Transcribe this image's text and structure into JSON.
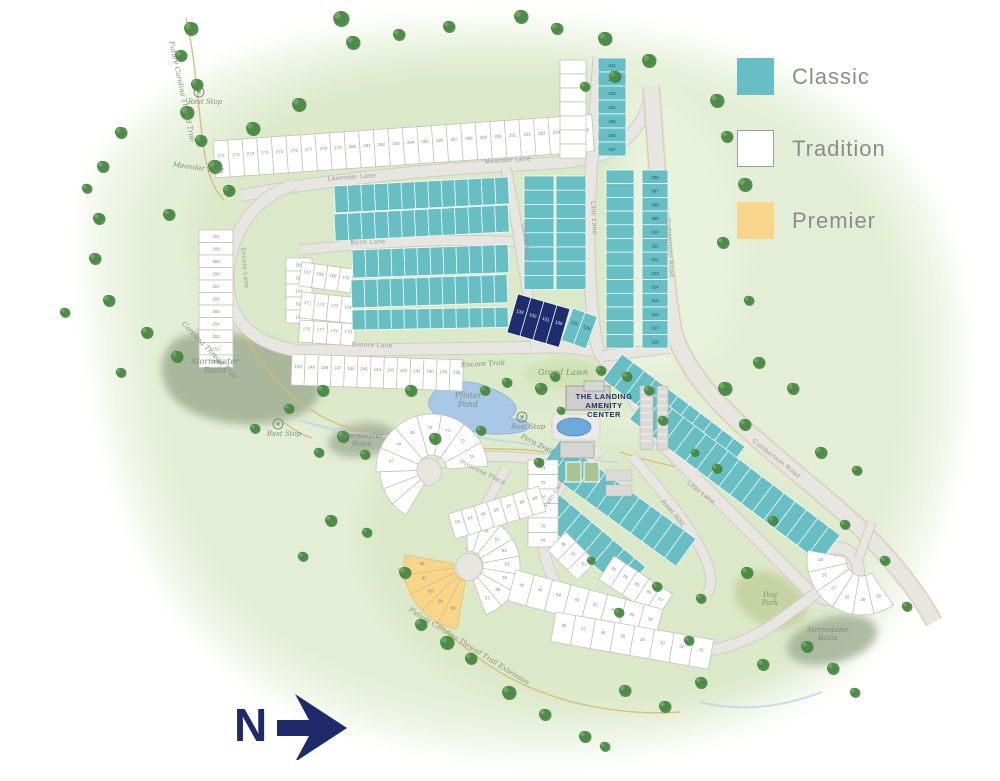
{
  "legend": {
    "items": [
      {
        "name": "classic",
        "label": "Classic",
        "fill": "#67bfc4",
        "border": "#67bfc4"
      },
      {
        "name": "tradition",
        "label": "Tradition",
        "fill": "#ffffff",
        "border": "#9aa09a"
      },
      {
        "name": "premier",
        "label": "Premier",
        "fill": "#f7d68c",
        "border": "#f7d68c"
      }
    ]
  },
  "north": {
    "label": "N",
    "color": "#1f2a6b"
  },
  "amenity": {
    "lines": [
      "THE LANDING",
      "AMENITY",
      "CENTER"
    ],
    "x": 604,
    "y": 399,
    "color": "#1c3461"
  },
  "road_labels": [
    {
      "text": "Lavender Lane",
      "x": 352,
      "y": 179,
      "rot": -4
    },
    {
      "text": "Meander Lane",
      "x": 508,
      "y": 162,
      "rot": -4
    },
    {
      "text": "Encore Lane",
      "x": 372,
      "y": 347,
      "rot": 2
    },
    {
      "text": "Encore Lane",
      "x": 243,
      "y": 268,
      "rot": 85
    },
    {
      "text": "Birch Lane",
      "x": 368,
      "y": 244,
      "rot": -2
    },
    {
      "text": "Clover Way",
      "x": 524,
      "y": 242,
      "rot": 84
    },
    {
      "text": "Lilac Lane",
      "x": 592,
      "y": 218,
      "rot": 87
    },
    {
      "text": "Lilac Lane",
      "x": 700,
      "y": 494,
      "rot": 38
    },
    {
      "text": "Cuthbertson Road",
      "x": 668,
      "y": 248,
      "rot": 86
    },
    {
      "text": "Cuthbertson Road",
      "x": 775,
      "y": 460,
      "rot": 38
    },
    {
      "text": "Fern Lane",
      "x": 556,
      "y": 494,
      "rot": -58
    },
    {
      "text": "Aster Way",
      "x": 672,
      "y": 514,
      "rot": 48
    },
    {
      "text": "Primrose Place",
      "x": 482,
      "y": 474,
      "rot": 26
    }
  ],
  "trail_labels": [
    {
      "text": "Meander Trail",
      "x": 198,
      "y": 170,
      "rot": 8
    },
    {
      "text": "Carolina Thread Trail",
      "x": 208,
      "y": 352,
      "rot": 46
    },
    {
      "text": "Future Carolina Thread Trail Extension",
      "x": 468,
      "y": 648,
      "rot": 32
    },
    {
      "text": "Future Carolina Thread Trail",
      "x": 180,
      "y": 92,
      "rot": 78
    },
    {
      "text": "Encore Trail",
      "x": 483,
      "y": 366,
      "rot": -3
    },
    {
      "text": "Fern Trail",
      "x": 536,
      "y": 446,
      "rot": 28
    }
  ],
  "place_labels": [
    {
      "lines": [
        "Stormwater",
        "Basin"
      ],
      "x": 215,
      "y": 364,
      "size": 8
    },
    {
      "lines": [
        "Stormwater",
        "Basin"
      ],
      "x": 362,
      "y": 438,
      "size": 7
    },
    {
      "lines": [
        "Stormwater",
        "Basin"
      ],
      "x": 828,
      "y": 632,
      "size": 7
    },
    {
      "lines": [
        "Dog",
        "Park"
      ],
      "x": 770,
      "y": 597,
      "size": 7
    },
    {
      "lines": [
        "Grand Lawn"
      ],
      "x": 563,
      "y": 375,
      "size": 8
    },
    {
      "lines": [
        "Pfister",
        "Pond"
      ],
      "x": 468,
      "y": 398,
      "size": 8
    }
  ],
  "rest_stops": [
    {
      "label": "Rest Stop",
      "x": 205,
      "y": 104
    },
    {
      "label": "Rest Stop",
      "x": 284,
      "y": 436
    },
    {
      "label": "Rest Stop",
      "x": 528,
      "y": 429
    }
  ],
  "highlight_lots": [
    "133",
    "132",
    "131",
    "130"
  ],
  "colors": {
    "classic": {
      "fill": "#67bfc4",
      "stroke": "#ffffff",
      "text": "#1c4a70"
    },
    "tradition": {
      "fill": "#ffffff",
      "stroke": "#bdbdb6",
      "text": "#8a8a84"
    },
    "premier": {
      "fill": "#f7d68c",
      "stroke": "#e2b968",
      "text": "#8b7a4a"
    },
    "highlight": {
      "fill": "#1d2d6e",
      "stroke": "#ffffff",
      "text": "#ffffff"
    },
    "road": "#e8e6e1",
    "road_casing": "#cfccc6",
    "trail": "#d8b96e",
    "pond": "#a9c8e8",
    "basin": "#a3b296",
    "lawn": "#cde2b4",
    "dogpark": "#c3d1a0",
    "label_green": "#7d8f78",
    "label_gray": "#9b9b97"
  },
  "blocks": [
    {
      "kind": "row",
      "lot": "tradition",
      "x": 213,
      "y": 141,
      "rot": -4,
      "w": 14.6,
      "d": 37,
      "n": 26,
      "nums": [
        "271",
        "272",
        "273",
        "274",
        "275",
        "276",
        "277",
        "278",
        "279",
        "280",
        "281",
        "282",
        "283",
        "284",
        "285",
        "286",
        "287",
        "288",
        "289",
        "290",
        "291",
        "292",
        "293",
        "294",
        "295",
        "296"
      ]
    },
    {
      "kind": "col",
      "lot": "tradition",
      "x": 199,
      "y": 230,
      "w": 12.5,
      "d": 34,
      "n": 11,
      "nums": [
        "161",
        "160",
        "159",
        "158",
        "157",
        "156",
        "155",
        "154",
        "153",
        "152",
        "151"
      ]
    },
    {
      "kind": "row",
      "lot": "tradition",
      "x": 292,
      "y": 354,
      "rot": 2,
      "w": 13.2,
      "d": 31,
      "n": 13,
      "nums": [
        "150",
        "149",
        "148",
        "147",
        "146",
        "145",
        "144",
        "143",
        "142",
        "141",
        "140",
        "139",
        "138"
      ]
    },
    {
      "kind": "col",
      "lot": "tradition",
      "x": 286,
      "y": 258,
      "w": 13,
      "d": 26,
      "n": 5,
      "nums": [
        "166",
        "165",
        "164",
        "163",
        "162"
      ]
    },
    {
      "kind": "row",
      "lot": "tradition",
      "x": 302,
      "y": 262,
      "rot": 8,
      "w": 13,
      "d": 24,
      "n": 4,
      "nums": [
        "167",
        "168",
        "169",
        "170"
      ]
    },
    {
      "kind": "row",
      "lot": "tradition",
      "x": 302,
      "y": 292,
      "rot": 6,
      "w": 13.5,
      "d": 26,
      "n": 5,
      "nums": [
        "171",
        "172",
        "173",
        "174",
        "175"
      ]
    },
    {
      "kind": "row",
      "lot": "tradition",
      "x": 300,
      "y": 320,
      "rot": 4,
      "w": 14,
      "d": 22,
      "n": 4,
      "nums": [
        "176",
        "177",
        "178",
        "179"
      ]
    },
    {
      "kind": "row",
      "lot": "classic",
      "x": 334,
      "y": 186,
      "rot": -3,
      "w": 13.4,
      "d": 27,
      "n": 13,
      "nums": []
    },
    {
      "kind": "row",
      "lot": "classic",
      "x": 334,
      "y": 214,
      "rot": -3,
      "w": 13.4,
      "d": 27,
      "n": 13,
      "nums": []
    },
    {
      "kind": "row",
      "lot": "classic",
      "x": 352,
      "y": 250,
      "rot": -2,
      "w": 13,
      "d": 28,
      "n": 12,
      "nums": []
    },
    {
      "kind": "row",
      "lot": "classic",
      "x": 351,
      "y": 280,
      "rot": -2,
      "w": 13,
      "d": 28,
      "n": 12,
      "nums": []
    },
    {
      "kind": "row",
      "lot": "classic",
      "x": 352,
      "y": 310,
      "rot": -1,
      "w": 13,
      "d": 20,
      "n": 12,
      "nums": []
    },
    {
      "kind": "col",
      "lot": "classic",
      "x": 524,
      "y": 176,
      "w": 14.2,
      "d": 30,
      "n": 8,
      "nums": []
    },
    {
      "kind": "col",
      "lot": "classic",
      "x": 556,
      "y": 176,
      "w": 14.2,
      "d": 30,
      "n": 8,
      "nums": []
    },
    {
      "kind": "row",
      "lot": "highlight",
      "x": 518,
      "y": 294,
      "rot": 16,
      "w": 13.5,
      "d": 40,
      "n": 4,
      "nums": [
        "133",
        "132",
        "131",
        "130"
      ]
    },
    {
      "kind": "row",
      "lot": "classic",
      "x": 573,
      "y": 308,
      "rot": 20,
      "w": 13,
      "d": 34,
      "n": 2,
      "nums": [
        "129",
        "128"
      ]
    },
    {
      "kind": "col",
      "lot": "tradition",
      "x": 560,
      "y": 60,
      "w": 14,
      "d": 26,
      "n": 7,
      "nums": []
    },
    {
      "kind": "col",
      "lot": "classic",
      "x": 598,
      "y": 58,
      "w": 14,
      "d": 28,
      "n": 7,
      "nums": [
        "341",
        "342",
        "343",
        "344",
        "345",
        "346",
        "347"
      ]
    },
    {
      "kind": "col",
      "lot": "classic",
      "x": 606,
      "y": 170,
      "w": 13.7,
      "d": 28,
      "n": 13,
      "nums": []
    },
    {
      "kind": "col",
      "lot": "classic",
      "x": 642,
      "y": 170,
      "w": 13.7,
      "d": 26,
      "n": 13,
      "nums": [
        "306",
        "307",
        "308",
        "309",
        "310",
        "311",
        "312",
        "313",
        "314",
        "315",
        "316",
        "317",
        "318"
      ]
    },
    {
      "kind": "row",
      "lot": "classic",
      "x": 622,
      "y": 354,
      "rot": 37,
      "w": 14,
      "d": 32,
      "n": 11,
      "nums": []
    },
    {
      "kind": "row",
      "lot": "classic",
      "x": 650,
      "y": 392,
      "rot": 37,
      "w": 14,
      "d": 34,
      "n": 17,
      "nums": []
    },
    {
      "kind": "row",
      "lot": "classic",
      "x": 560,
      "y": 440,
      "rot": 36,
      "w": 14,
      "d": 34,
      "n": 12,
      "nums": []
    },
    {
      "kind": "row",
      "lot": "classic",
      "x": 549,
      "y": 486,
      "rot": 40,
      "w": 14,
      "d": 32,
      "n": 9,
      "nums": []
    },
    {
      "kind": "col",
      "lot": "tradition",
      "x": 528,
      "y": 460,
      "w": 14.5,
      "d": 30,
      "n": 6,
      "nums": [
        "74",
        "75",
        "76",
        "77",
        "78",
        "79"
      ]
    },
    {
      "kind": "row",
      "lot": "tradition",
      "x": 566,
      "y": 532,
      "rot": 45,
      "w": 14,
      "d": 26,
      "n": 3,
      "nums": [
        "80",
        "81",
        "82"
      ]
    },
    {
      "kind": "row",
      "lot": "tradition",
      "x": 614,
      "y": 556,
      "rot": 33,
      "w": 14,
      "d": 28,
      "n": 5,
      "nums": [
        "83",
        "84",
        "85",
        "86",
        "87"
      ]
    },
    {
      "kind": "fan",
      "lot": "tradition",
      "cx": 432,
      "cy": 470,
      "r0": 15,
      "r1": 56,
      "a0": 178,
      "a1": 356,
      "n": 7,
      "nums": [
        "47",
        "48",
        "49",
        "70",
        "71",
        "72",
        "73"
      ]
    },
    {
      "kind": "fan",
      "lot": "tradition",
      "cx": 432,
      "cy": 470,
      "r0": 15,
      "r1": 52,
      "a0": 120,
      "a1": 178,
      "n": 3,
      "nums": []
    },
    {
      "kind": "fan",
      "lot": "tradition",
      "cx": 468,
      "cy": 566,
      "r0": 15,
      "r1": 52,
      "a0": 268,
      "a1": 430,
      "n": 8,
      "nums": [
        "50",
        "51",
        "52",
        "53",
        "54",
        "55",
        "56",
        "57"
      ]
    },
    {
      "kind": "fan",
      "lot": "premier",
      "cx": 468,
      "cy": 566,
      "r0": 15,
      "r1": 64,
      "a0": 100,
      "a1": 190,
      "n": 5,
      "nums": [
        "58",
        "59",
        "60",
        "61",
        "62"
      ]
    },
    {
      "kind": "row",
      "lot": "tradition",
      "x": 448,
      "y": 514,
      "rot": -17,
      "w": 13.5,
      "d": 26,
      "n": 7,
      "nums": [
        "63",
        "64",
        "65",
        "66",
        "67",
        "68",
        "69"
      ]
    },
    {
      "kind": "row",
      "lot": "tradition",
      "x": 516,
      "y": 570,
      "rot": 15,
      "w": 19,
      "d": 32,
      "n": 8,
      "nums": [
        "46",
        "45",
        "44",
        "43",
        "42",
        "41",
        "40",
        "39"
      ]
    },
    {
      "kind": "row",
      "lot": "tradition",
      "x": 556,
      "y": 612,
      "rot": 10,
      "w": 20,
      "d": 30,
      "n": 8,
      "nums": [
        "38",
        "37",
        "36",
        "35",
        "34",
        "33",
        "32",
        "31"
      ]
    },
    {
      "kind": "fan",
      "lot": "tradition",
      "cx": 862,
      "cy": 560,
      "r0": 16,
      "r1": 55,
      "a0": 55,
      "a1": 190,
      "n": 6,
      "nums": [
        "30",
        "29",
        "28",
        "27",
        "26",
        "25"
      ]
    }
  ]
}
